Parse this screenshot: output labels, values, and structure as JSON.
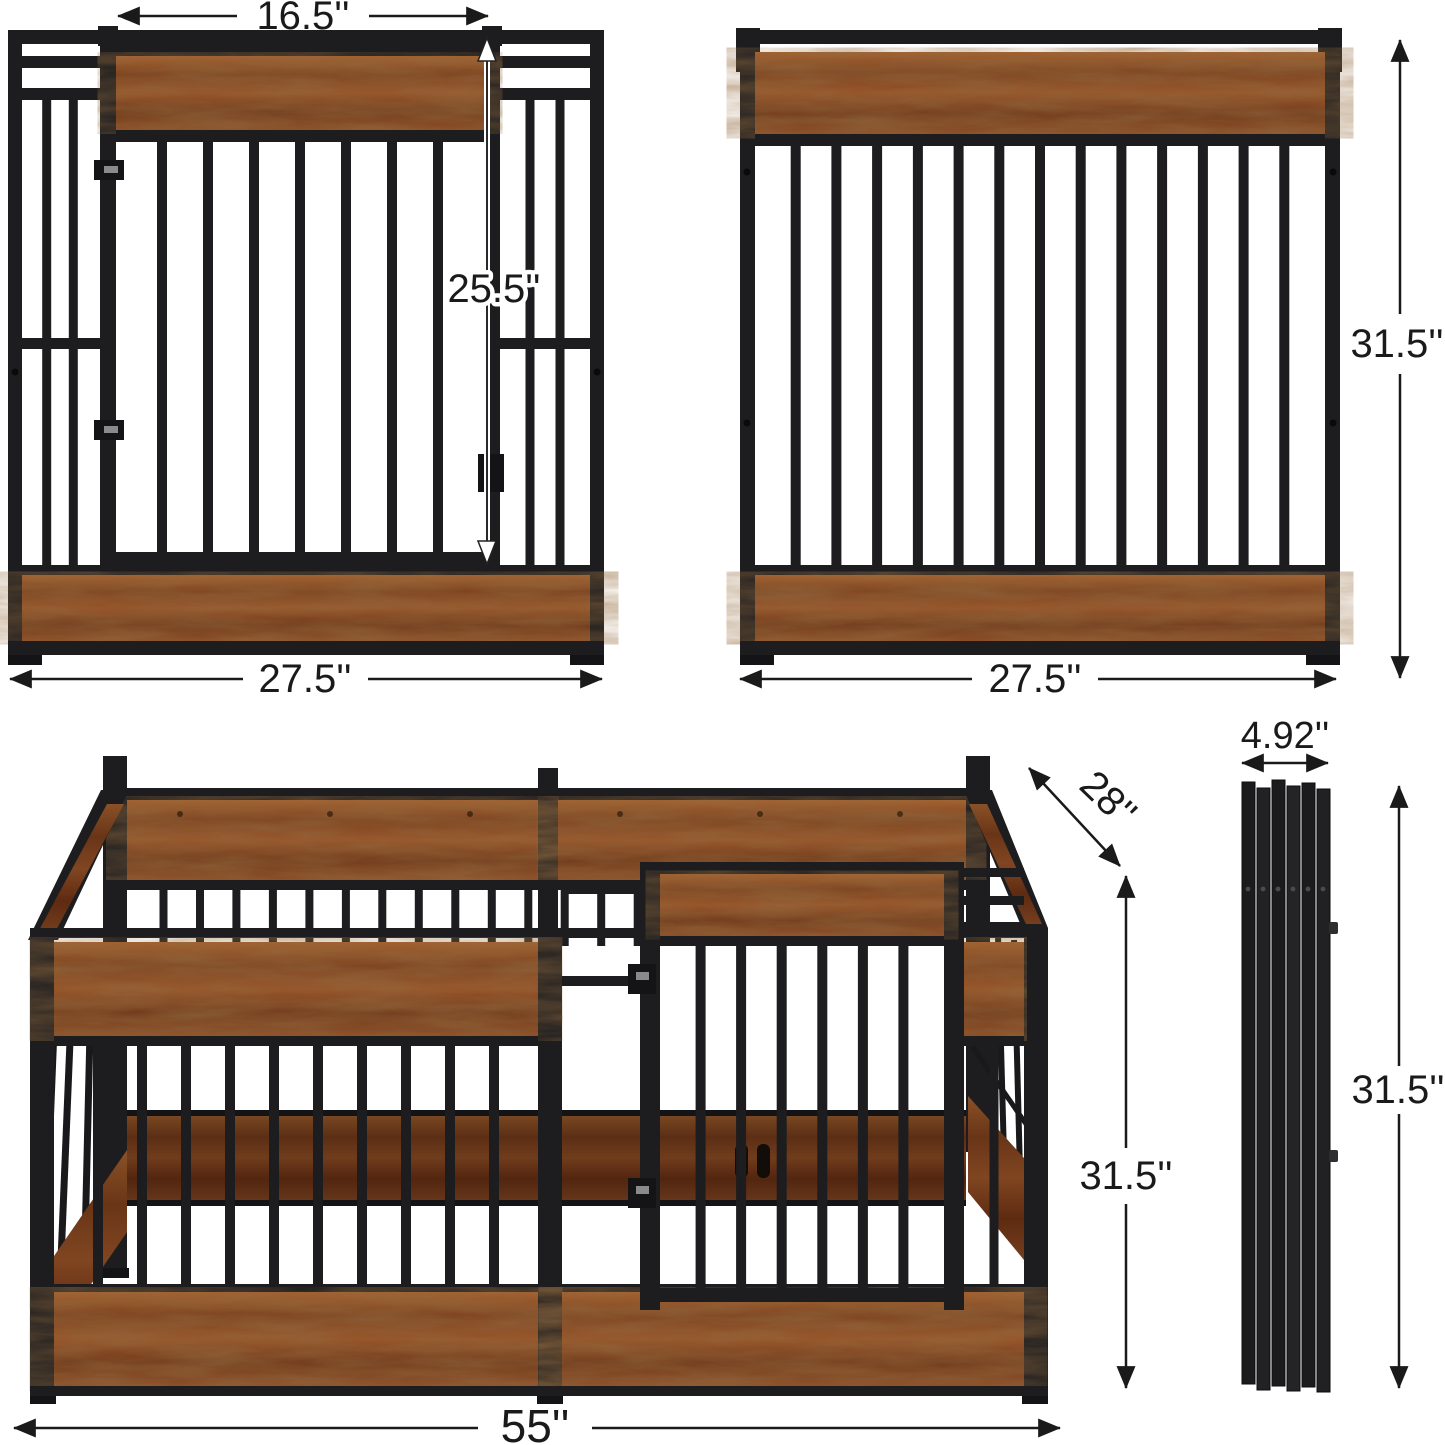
{
  "colors": {
    "background": "#ffffff",
    "metal": "#1d1d1f",
    "wood": "#8a4a26",
    "dimension": "#1a1a1a"
  },
  "panels": {
    "front_left": {
      "door_width": "16.5''",
      "door_height": "25.5''",
      "width": "27.5''"
    },
    "back_right": {
      "height": "31.5''",
      "width": "27.5''"
    },
    "assembled_pen": {
      "depth": "28''",
      "height": "31.5''",
      "width": "55''"
    },
    "folded_stack": {
      "depth": "4.92''",
      "height": "31.5''"
    }
  }
}
